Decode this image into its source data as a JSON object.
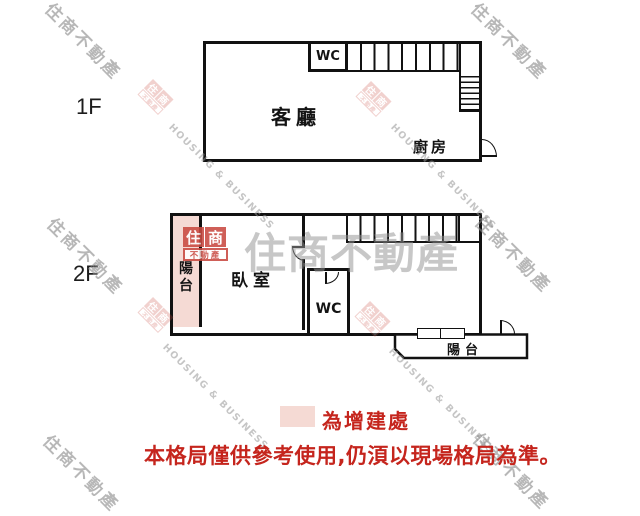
{
  "floors": {
    "f1": {
      "label": "1F",
      "living": "客廳",
      "kitchen": "廚房",
      "wc": "WC"
    },
    "f2": {
      "label": "2F",
      "bedroom": "臥室",
      "wc": "WC",
      "balcony_left": "陽台",
      "balcony_right": "陽台"
    }
  },
  "legend": {
    "addition_label": "為增建處",
    "disclaimer": "本格局僅供參考使用,仍湏以現場格局為準。"
  },
  "watermark": {
    "brand": "住商不動產",
    "brand_en": "HOUSING & BUSINESS",
    "logo_char1": "住",
    "logo_char2": "商",
    "logo_bottom": "不動產"
  },
  "colors": {
    "addition_pink": "#f5dad4",
    "warning_red": "#c5251d",
    "logo_red": "#c94a41",
    "wall_black": "#111111",
    "watermark_gray": "#888888"
  }
}
